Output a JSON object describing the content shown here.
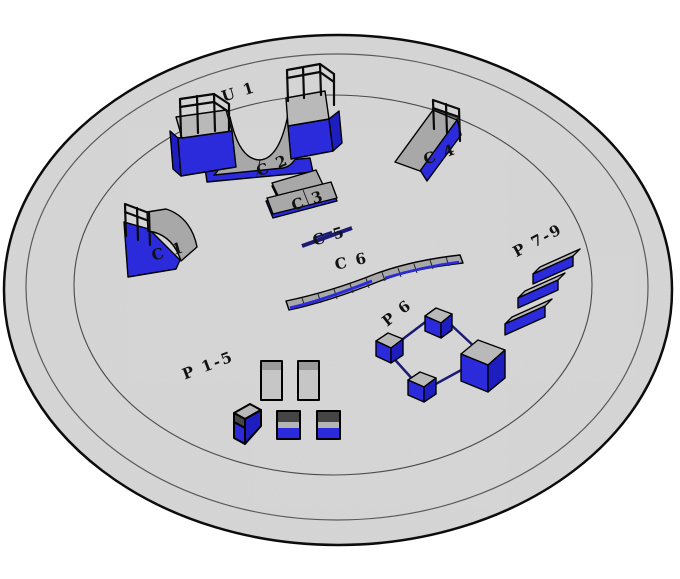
{
  "scene": {
    "type": "3d-model-viewport",
    "description": "circular skatepark platform with labeled obstacles",
    "background": "#ffffff"
  },
  "platform": {
    "shape": "circular dish seen in perspective",
    "ring_lines": 3,
    "surface_color": "#d6d6d6",
    "outline_color": "#000000"
  },
  "labels": {
    "u1": "U 1",
    "c1": "C 1",
    "c2": "C 2",
    "c3": "C 3",
    "c4": "C 4",
    "c5": "C 5",
    "c6": "C 6",
    "p1_5": "P 1-5",
    "p6": "P 6",
    "p7_9": "P 7-9"
  },
  "obstacles": [
    {
      "id": "u1",
      "label": "U 1",
      "kind": "halfpipe with rails on both decks"
    },
    {
      "id": "c1",
      "label": "C 1",
      "kind": "quarterpipe with rail"
    },
    {
      "id": "c2",
      "label": "C 2",
      "kind": "upper slab of pyramid box"
    },
    {
      "id": "c3",
      "label": "C 3",
      "kind": "lower slab of pyramid box"
    },
    {
      "id": "c4",
      "label": "C 4",
      "kind": "bank ramp with rail"
    },
    {
      "id": "c5",
      "label": "C 5",
      "kind": "flat rail"
    },
    {
      "id": "c6",
      "label": "C 6",
      "kind": "long segmented ledge"
    },
    {
      "id": "p1_5",
      "label": "P 1-5",
      "kind": "two tall boxes and three banded cubes"
    },
    {
      "id": "p6",
      "label": "P 6",
      "kind": "four boxes connected by square rail"
    },
    {
      "id": "p7_9",
      "label": "P 7-9",
      "kind": "three parallel angled ledges"
    }
  ],
  "colors": {
    "background": "#ffffff",
    "platform_fill": "#d6d6d6",
    "edge_stroke": "#000000",
    "obstacle_blue": "#2b2bdc",
    "obstacle_blue_dark": "#1d1dc0",
    "obstacle_gray": "#a8a8a8",
    "obstacle_gray_light": "#b9b9b9",
    "obstacle_gray_dark": "#454545",
    "rail_navy": "#1b1b73",
    "label_color": "#111111"
  }
}
